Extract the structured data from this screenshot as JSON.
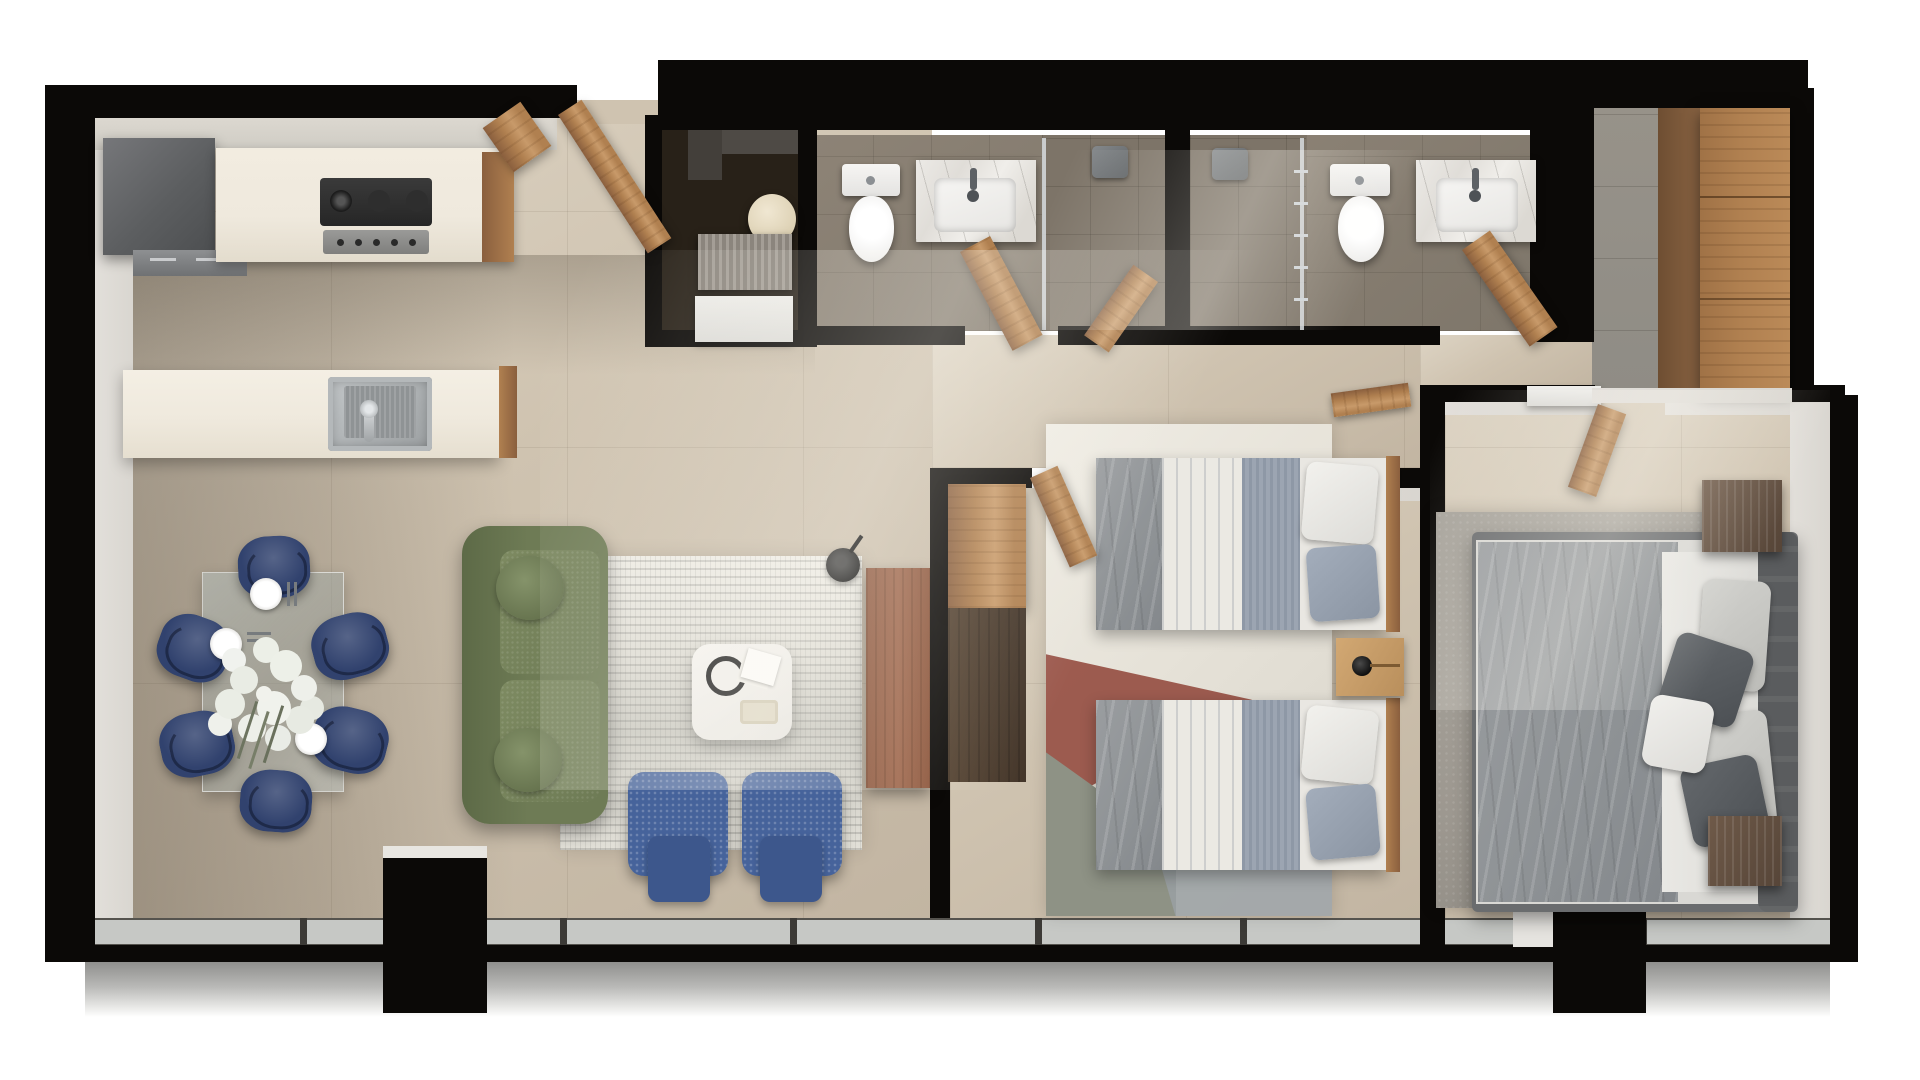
{
  "meta": {
    "kind": "apartment-floor-plan-render",
    "text_visible": false
  },
  "palette": {
    "wall-black": "#0b0907",
    "beige": "#cfc3b0",
    "beige-light": "#ddd4c4",
    "taupe": "#8e8478",
    "bath-floor": "#8d8376",
    "closet-floor": "#282118",
    "entry-floor": "#8f8c85",
    "wood": "#b08050",
    "wood-dark": "#8a5f3e",
    "wood-light": "#c89a6a",
    "console-wood": "#9c6348",
    "cream": "#efe9dd",
    "steel": "#a8acae",
    "glass": "#c6c8c5",
    "navy": "#31426e",
    "blue": "#46639b",
    "sofa-green": "#6e7b55",
    "sofa-green-dark": "#5d6a47",
    "rug-red": "#964f43",
    "rug-sage": "#8e9285",
    "gray-rug": "#9d9890",
    "duvet": "#8f9396",
    "headboard": "#5a5c5e",
    "wall-light": "#d9d6d0",
    "balcony": "#a3a3a1"
  },
  "rooms": [
    {
      "id": "kitchen",
      "furniture": [
        "refrigerator",
        "counter",
        "gas-cooktop",
        "island",
        "sink"
      ]
    },
    {
      "id": "dining-area",
      "furniture": [
        "glass-table",
        "dining-chair-x6",
        "plates",
        "flower-centerpiece"
      ]
    },
    {
      "id": "living-room",
      "furniture": [
        "green-sofa",
        "area-rug",
        "coffee-table",
        "blue-armchair-x2",
        "tv-console",
        "wall-clock"
      ]
    },
    {
      "id": "utility-closet",
      "furniture": [
        "washer",
        "vent-unit",
        "white-appliance"
      ]
    },
    {
      "id": "bathroom-1",
      "furniture": [
        "toilet",
        "marble-vanity",
        "shower",
        "door"
      ]
    },
    {
      "id": "bathroom-2",
      "furniture": [
        "shower",
        "toilet",
        "marble-vanity",
        "door"
      ]
    },
    {
      "id": "bedroom-twin",
      "furniture": [
        "geometric-rug",
        "twin-bed-x2",
        "nightstand-lamp",
        "wardrobe-cabinets",
        "door"
      ]
    },
    {
      "id": "master-bedroom",
      "furniture": [
        "gray-rug",
        "double-bed",
        "nightstand-x2",
        "shelves",
        "door"
      ]
    },
    {
      "id": "entry-hall",
      "furniture": [
        "entry-door",
        "tall-wardrobe"
      ]
    },
    {
      "id": "balcony",
      "furniture": [
        "window-band",
        "columns"
      ]
    }
  ]
}
